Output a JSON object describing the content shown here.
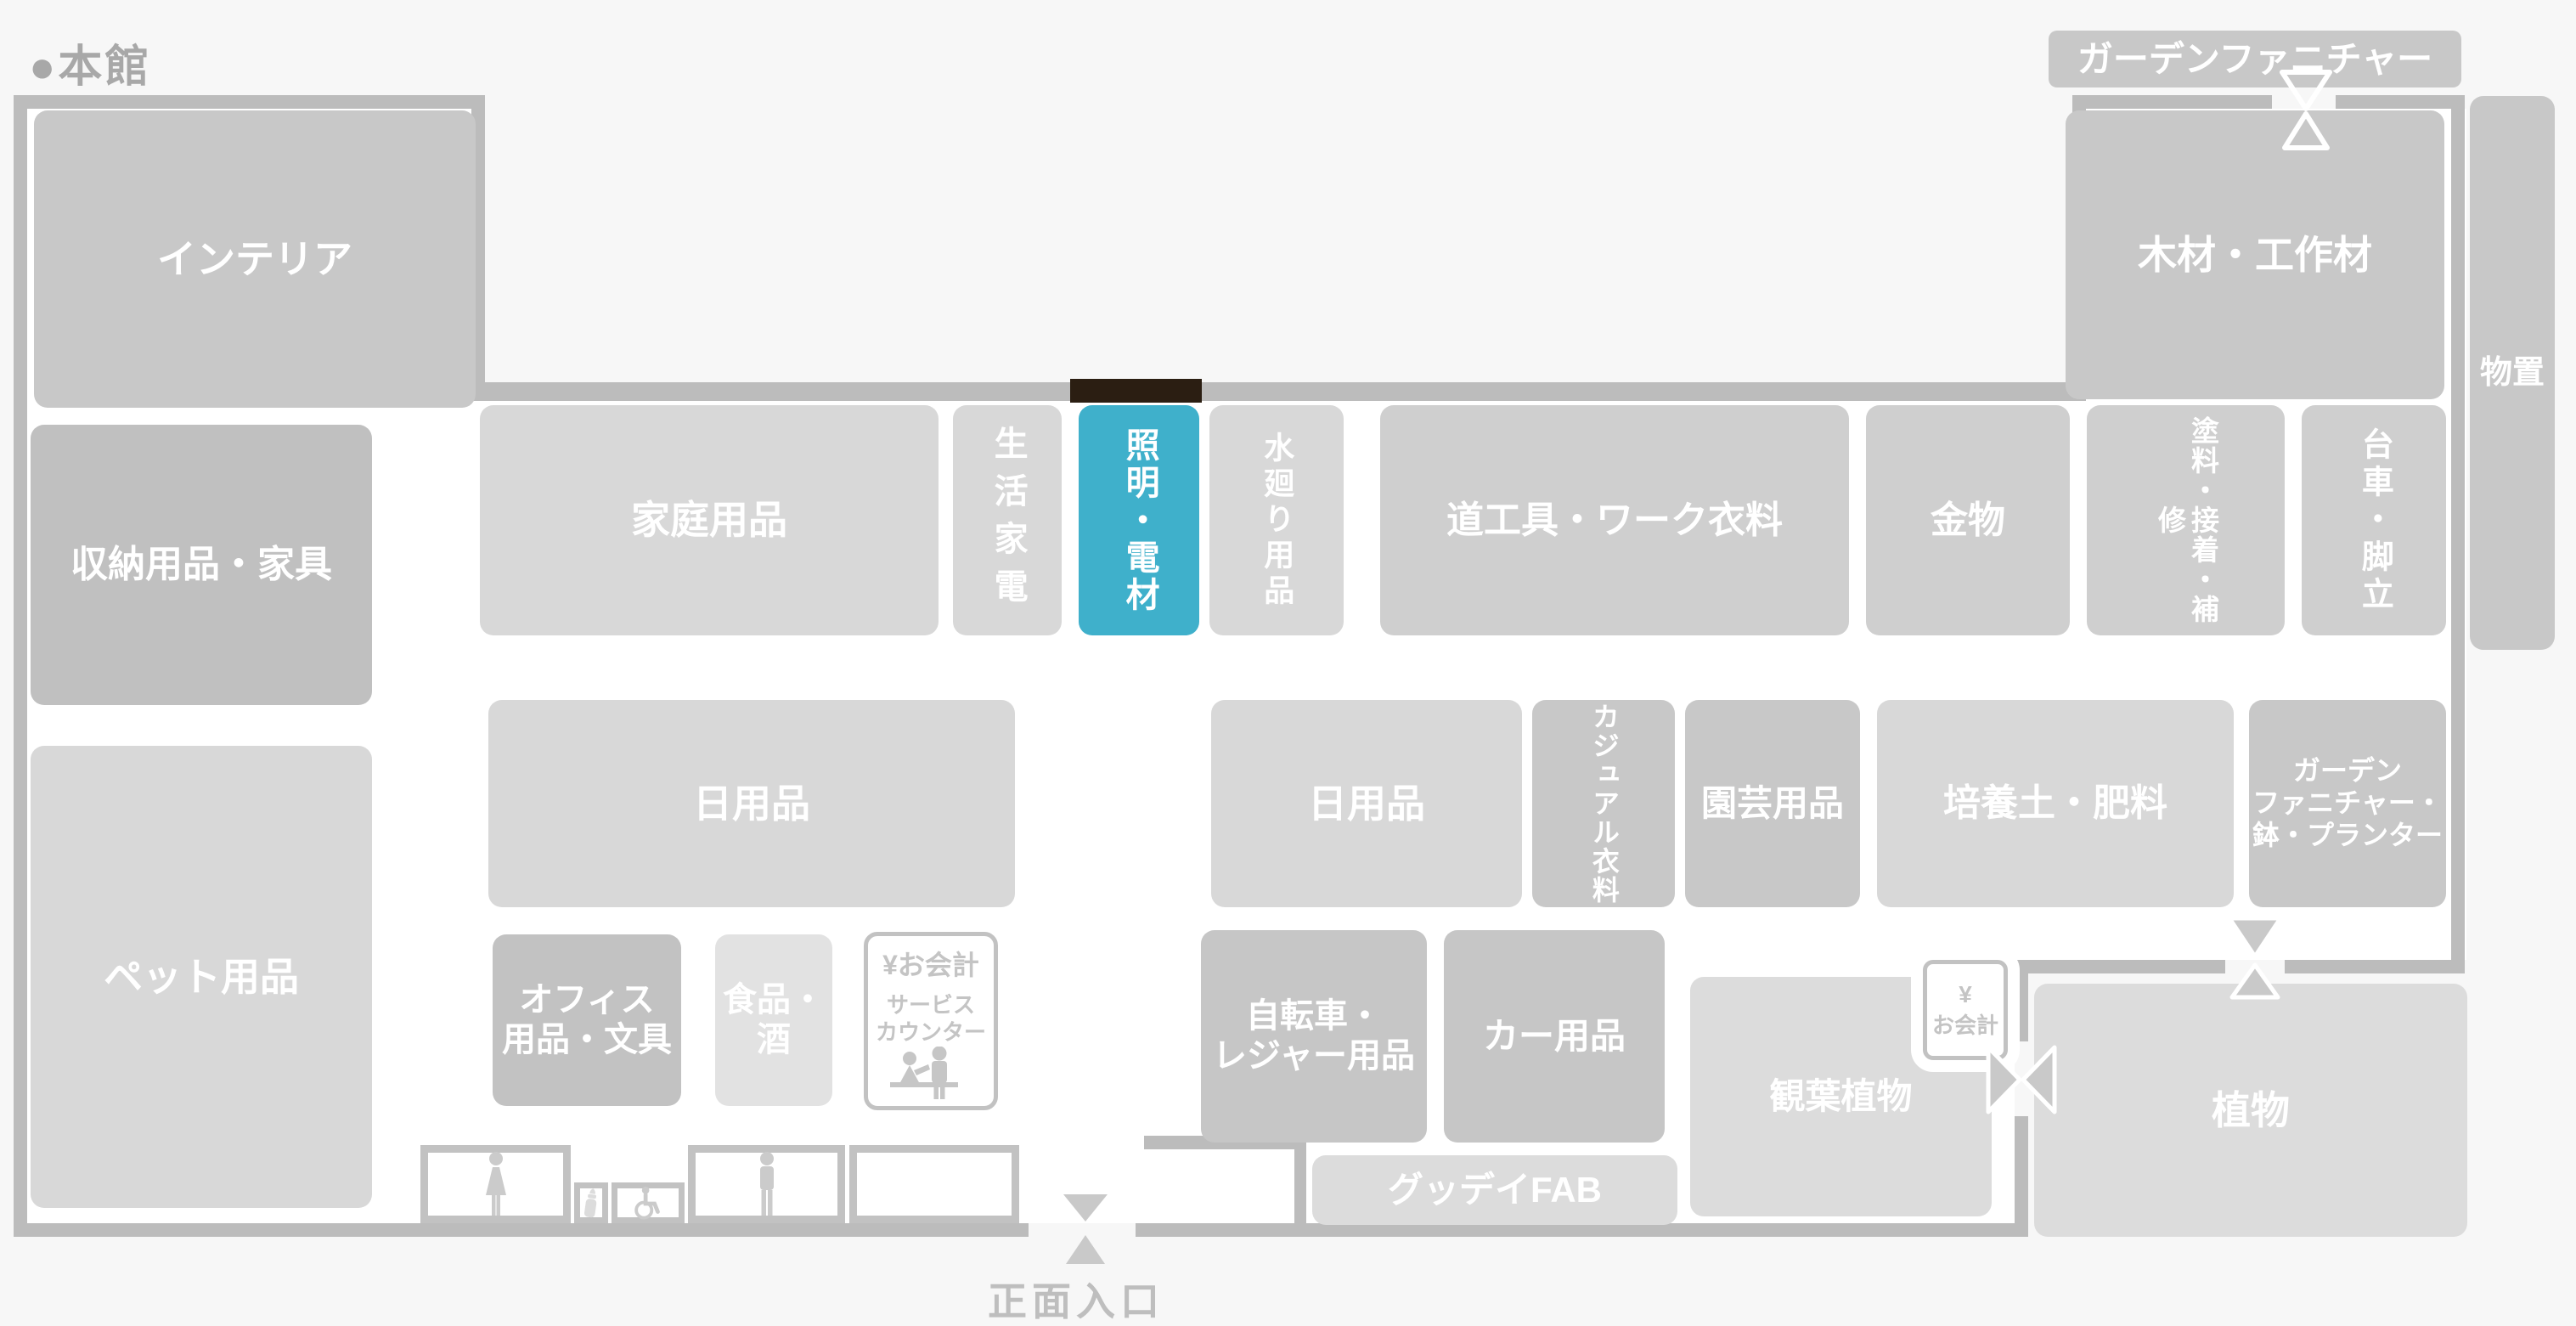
{
  "page": {
    "title": "●本館",
    "background_color": "#F7F7F7",
    "wall_color": "#BCBCBC",
    "highlight_color": "#3FB0CB",
    "highlight_wall_marker_color": "#2B1E12",
    "highlighted_department": "照明・電材"
  },
  "outside_labels": {
    "garden_furniture": "ガーデンファニチャー",
    "storage_shed": "物置",
    "main_entrance": "正面入口"
  },
  "departments": {
    "interior": "インテリア",
    "storage_furniture": "収納用品・家具",
    "pets": "ペット用品",
    "household": "家庭用品",
    "appliances": "生活家電",
    "lighting": "照明・電材",
    "plumbing": "水廻り用品",
    "tools_workwear": "道工具・ワーク衣料",
    "hardware": "金物",
    "paint_repair": "塗料・接着・補修",
    "carts_ladders": "台車・脚立",
    "lumber": "木材・工作材",
    "daily_left": "日用品",
    "daily_right": "日用品",
    "office": {
      "line1": "オフィス",
      "line2": "用品・文具"
    },
    "food": {
      "line1": "食品・",
      "line2": "酒"
    },
    "casual": "カジュアル衣料",
    "gardening": "園芸用品",
    "soil_fertilizer": "培養土・肥料",
    "garden_pots": {
      "line1": "ガーデン",
      "line2": "ファニチャー・",
      "line3": "鉢・プランター"
    },
    "bicycle_leisure": {
      "line1": "自転車・",
      "line2": "レジャー用品"
    },
    "car": "カー用品",
    "gooday_fab": "グッデイFAB",
    "houseplants": "観葉植物",
    "plants": "植物"
  },
  "service_counter": {
    "checkout": "¥お会計",
    "line1": "サービス",
    "line2": "カウンター"
  },
  "checkout_small": {
    "yen": "¥",
    "label": "お会計"
  },
  "icons": [
    "woman-icon",
    "man-icon",
    "baby-bottle-icon",
    "wheelchair-icon",
    "service-counter-icon",
    "entrance-marker-icon"
  ]
}
